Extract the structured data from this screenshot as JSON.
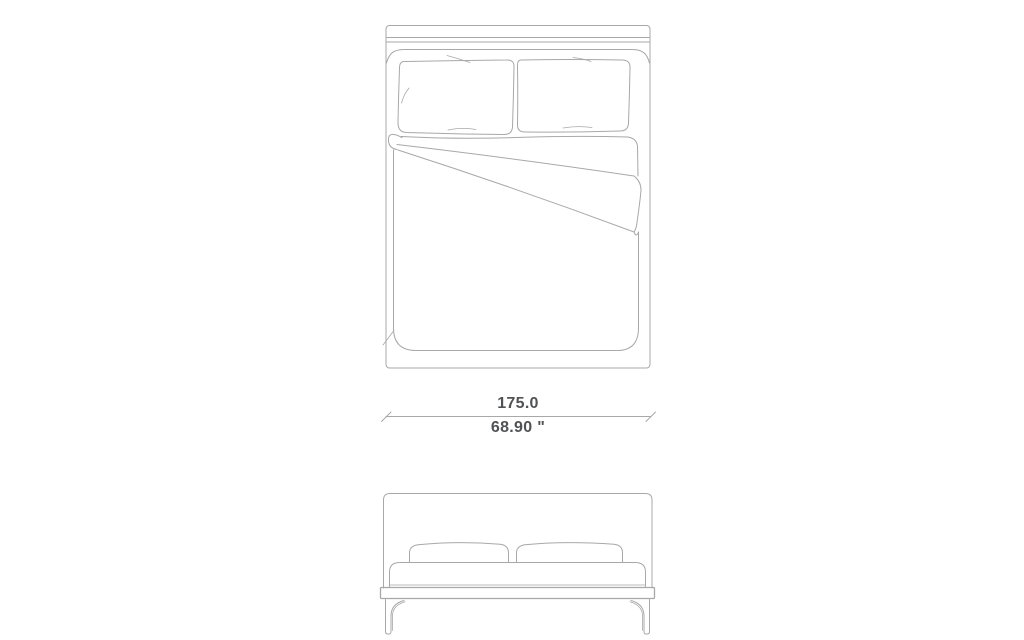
{
  "diagram": {
    "dimension": {
      "width_cm": "175.0",
      "width_inches": "68.90 \""
    },
    "colors": {
      "background": "#ffffff",
      "line": "#a8a8a8",
      "text": "#515254"
    }
  }
}
